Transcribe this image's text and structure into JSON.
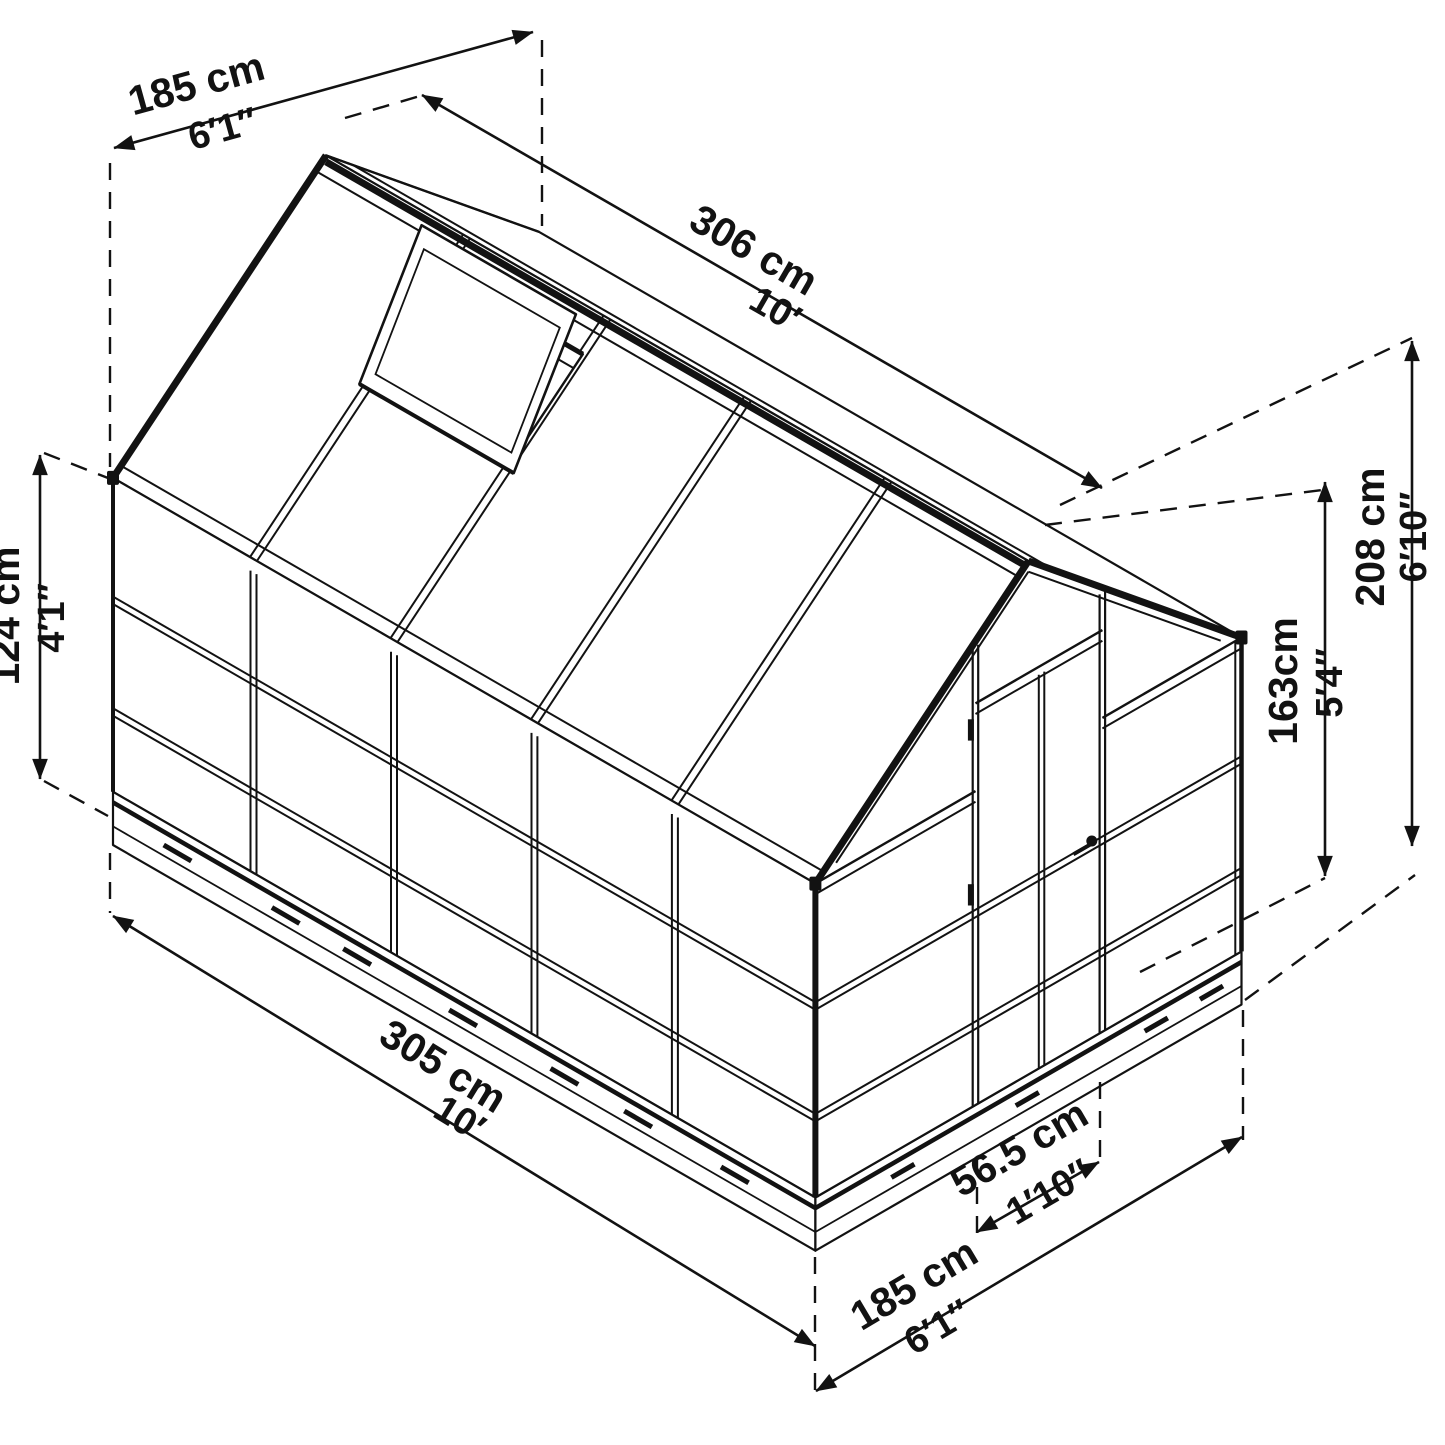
{
  "diagram": {
    "type": "isometric-greenhouse-dimension-drawing",
    "colors": {
      "line": "#121212",
      "background": "#ffffff"
    },
    "dimensions": {
      "back_width": {
        "cm": "185 cm",
        "imperial": "6′1″"
      },
      "ridge_length": {
        "cm": "306 cm",
        "imperial": "10′"
      },
      "side_wall_height": {
        "cm": "124 cm",
        "imperial": "4′1″"
      },
      "peak_height": {
        "cm": "208 cm",
        "imperial": "6′10″"
      },
      "door_height": {
        "cm": "163cm",
        "imperial": "5′4″"
      },
      "base_length": {
        "cm": "305 cm",
        "imperial": "10′"
      },
      "door_width": {
        "cm": "56.5 cm",
        "imperial": "1′10″"
      },
      "front_width": {
        "cm": "185 cm",
        "imperial": "6′1″"
      }
    }
  }
}
